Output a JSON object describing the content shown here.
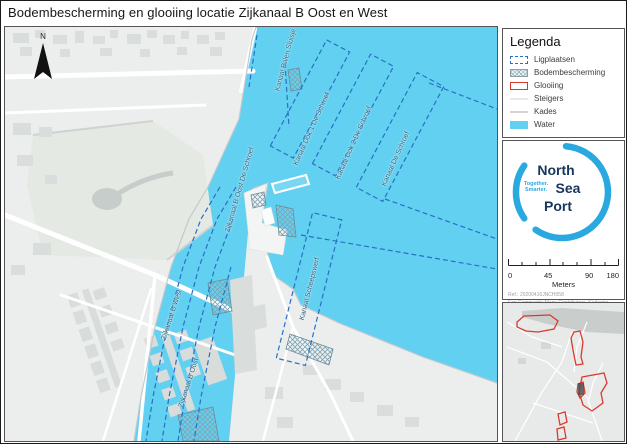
{
  "title": "Bodembescherming en glooiing locatie Zijkanaal B Oost en West",
  "map": {
    "north_label": "N",
    "labels": [
      {
        "text": "Kanaal Palen Sluisje"
      },
      {
        "text": "Kanaal Dok 1 De Schroef"
      },
      {
        "text": "Kanaal Dok 2 De Schroef"
      },
      {
        "text": "Kanaal De Schroef"
      },
      {
        "text": "Zijkanaal B Oost De Schroef"
      },
      {
        "text": "Kanaal Scheepswerf"
      },
      {
        "text": "Zijkanaal B West"
      },
      {
        "text": "Zijkanaal B Oost"
      }
    ]
  },
  "legend": {
    "title": "Legenda",
    "items": [
      {
        "label": "Ligplaatsen",
        "swatch": "dashed-blue-rect"
      },
      {
        "label": "Bodembescherming",
        "swatch": "crosshatch"
      },
      {
        "label": "Glooiing",
        "swatch": "red-outline-rect"
      },
      {
        "label": "Steigers",
        "swatch": "white-line"
      },
      {
        "label": "Kades",
        "swatch": "gray-line"
      },
      {
        "label": "Water",
        "swatch": "cyan-fill"
      }
    ]
  },
  "logo": {
    "name": "North Sea Port",
    "word1": "North",
    "word2": "Sea",
    "word3": "Port",
    "tagline_line1": "Together.",
    "tagline_line2": "Smarter."
  },
  "scalebar": {
    "tick_labels": [
      "0",
      "45",
      "90",
      "180"
    ],
    "unit": "Meters"
  },
  "attribution": {
    "ref": "Ref.: 20200416JNCH058",
    "credits": "Esri Community Maps Contributors, Kadaster, Esri, TomTom, Garmin, GeoTechnologies, Inc., METI/NASA, USGS, Kadaster, Esri, TomTom, Garmin, FAO, METI/NASA, USGS"
  },
  "colors": {
    "water": "#62D1F1",
    "land": "#EBEEEC",
    "building": "#D9DDDB",
    "ligplaats_dash": "#2A6FC4",
    "glooiing_red": "#D93A2F",
    "logo_light_blue": "#2AA9E0",
    "logo_navy": "#16365C",
    "label_blue": "#2A5F7E"
  }
}
